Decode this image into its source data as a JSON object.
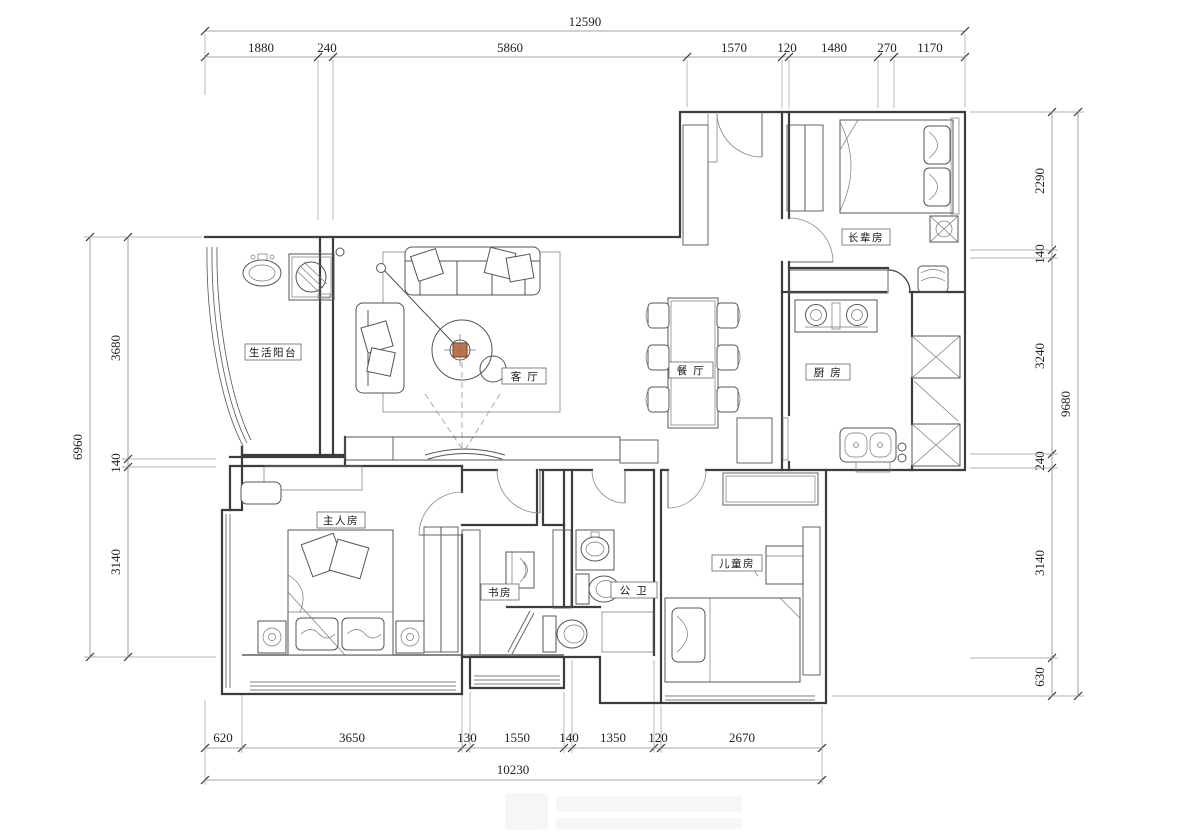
{
  "rooms": {
    "balcony": "生活阳台",
    "living": "客 厅",
    "dining": "餐 厅",
    "elder": "长辈房",
    "kitchen": "厨 房",
    "master": "主人房",
    "study": "书房",
    "bath": "公 卫",
    "kids": "儿童房"
  },
  "dimensions": {
    "top": {
      "total": "12590",
      "segments": [
        "1880",
        "240",
        "5860",
        "1570",
        "120",
        "1480",
        "270",
        "1170"
      ]
    },
    "bottom": {
      "total": "10230",
      "segments": [
        "620",
        "3650",
        "130",
        "1550",
        "140",
        "1350",
        "120",
        "2670"
      ]
    },
    "left": {
      "total": "6960",
      "segments": [
        "3680",
        "140",
        "3140"
      ]
    },
    "right": {
      "total": "9680",
      "segments": [
        "2290",
        "140",
        "3240",
        "240",
        "3140",
        "630"
      ]
    }
  },
  "colors": {
    "line": "#3d3d3d",
    "accent": "#bf7244"
  }
}
